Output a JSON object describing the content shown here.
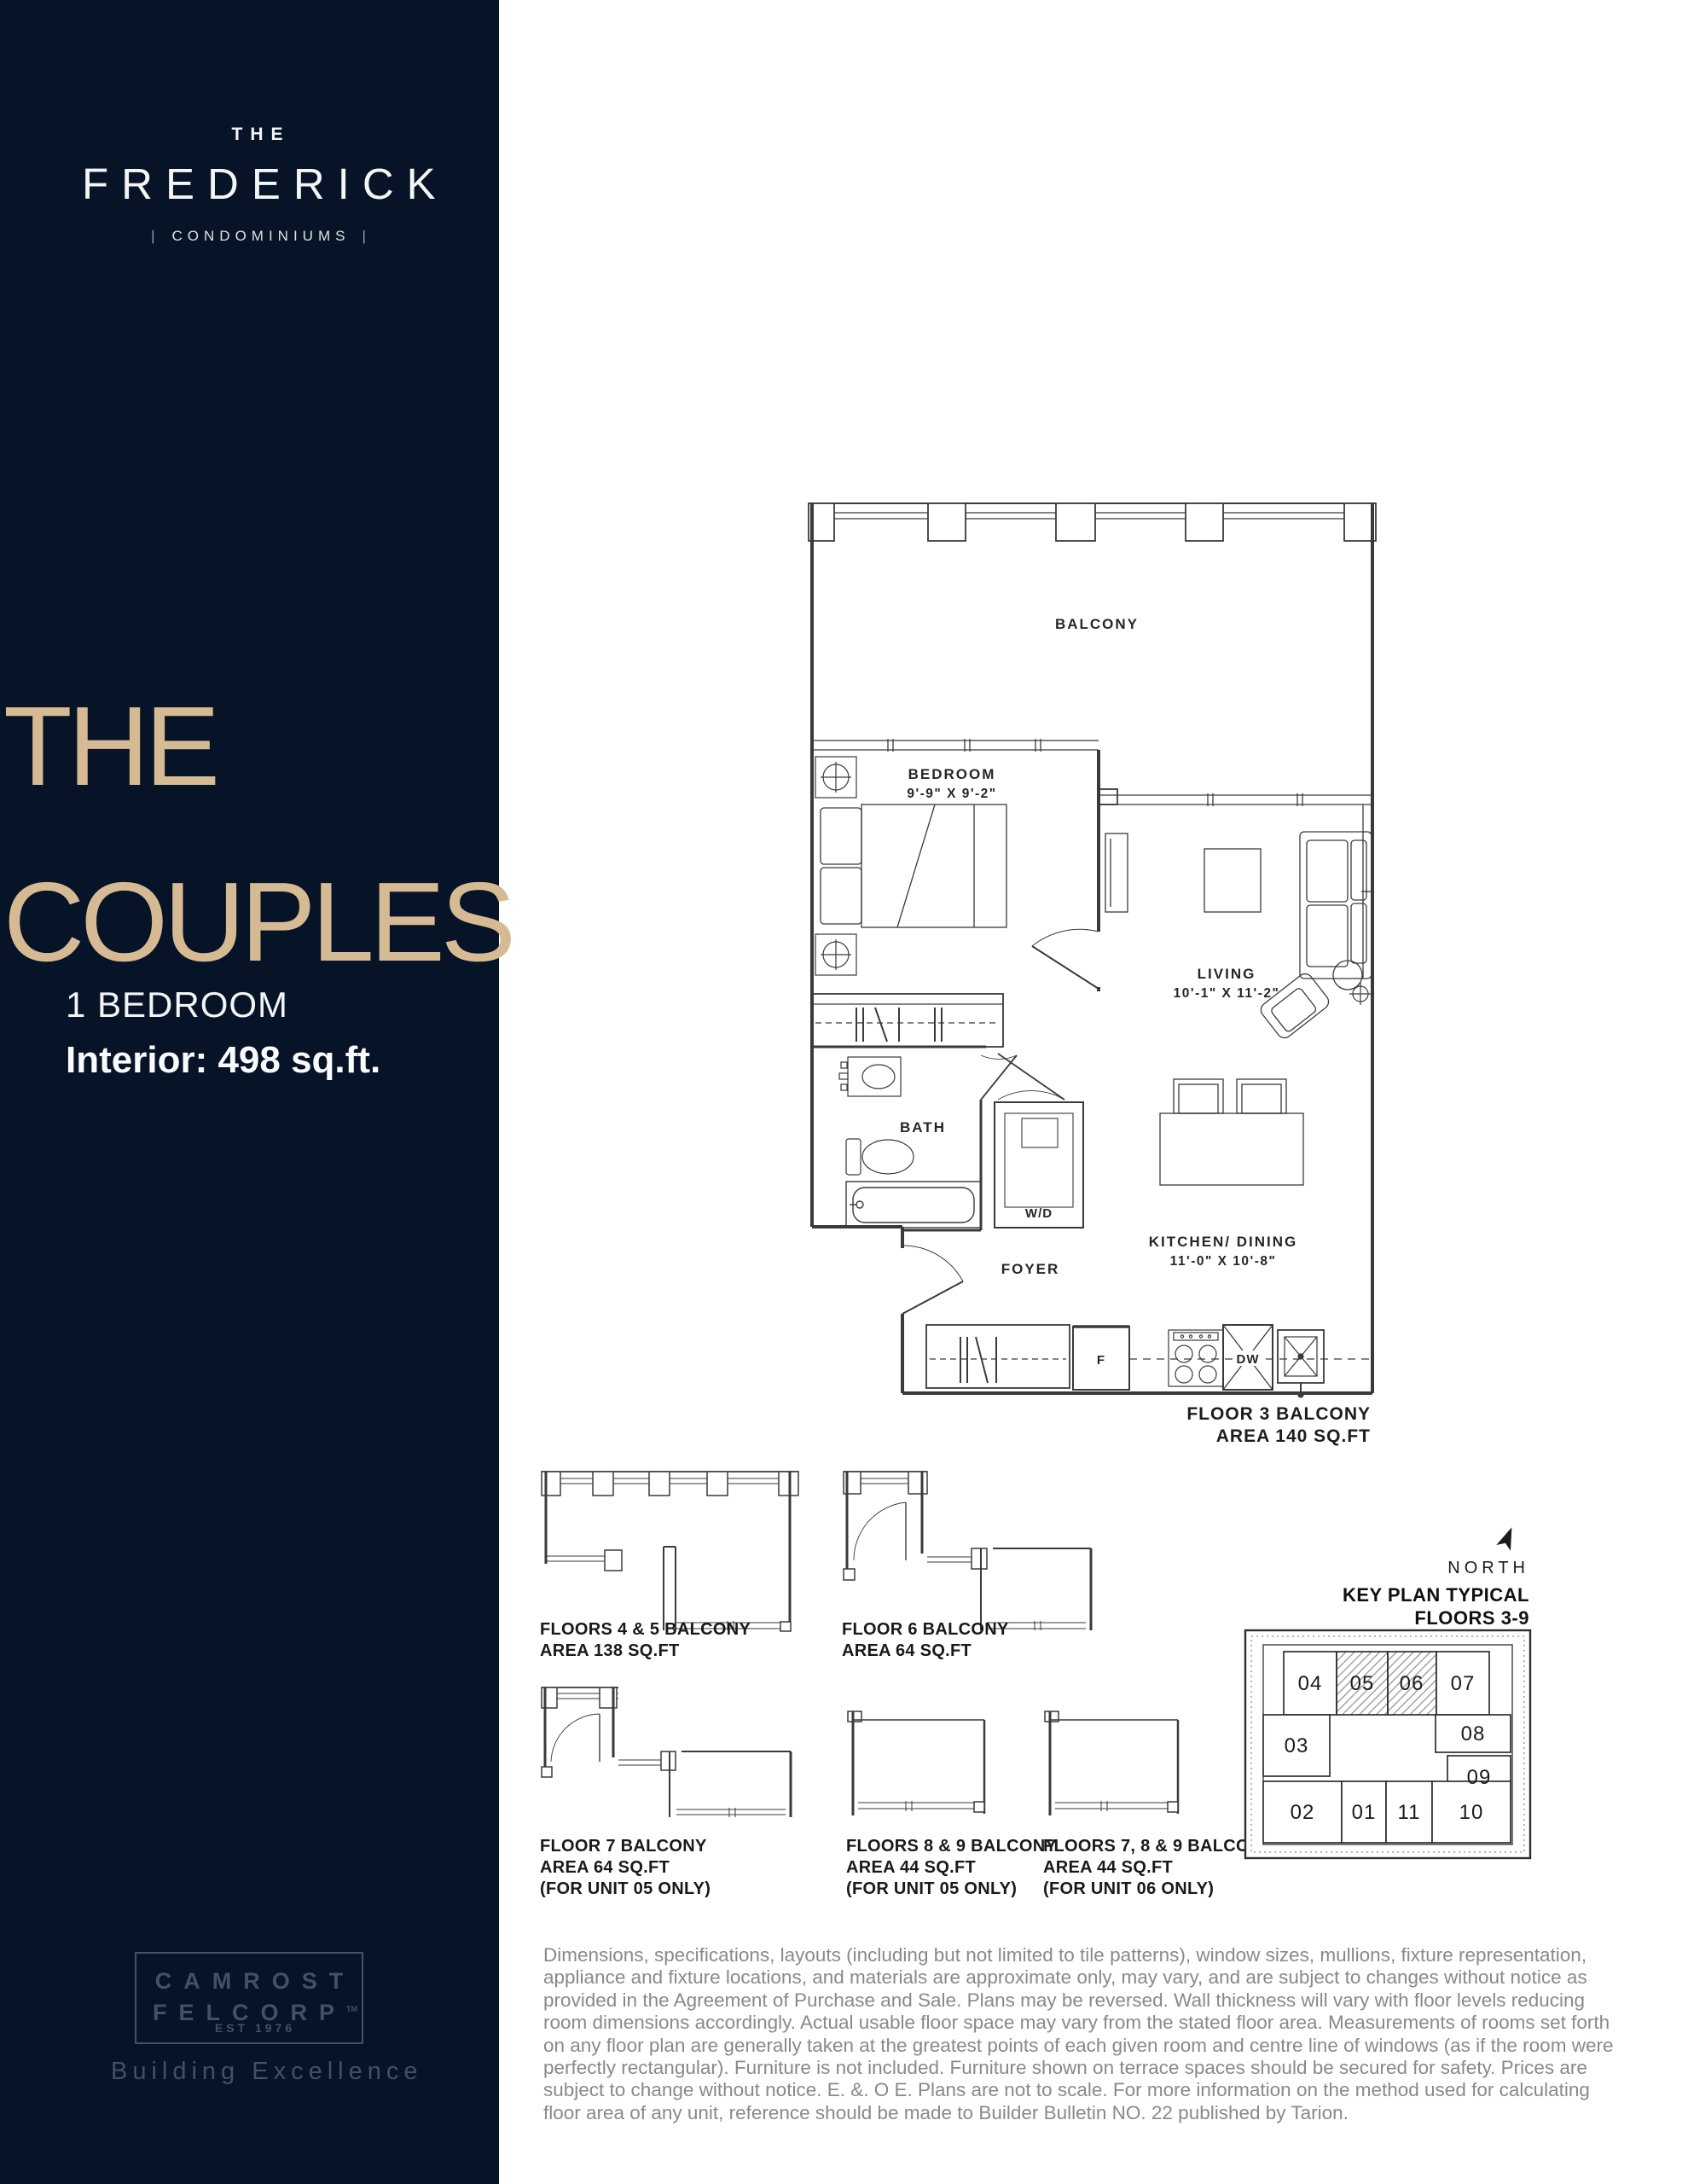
{
  "colors": {
    "navy": "#071326",
    "gold": "#d6ba93",
    "logo_muted": "#41506b",
    "plan_line": "#3a3a3a",
    "disclaimer_gray": "#87898b"
  },
  "sidebar": {
    "logo": {
      "the": "THE",
      "name": "FREDERICK",
      "tagline": "CONDOMINIUMS",
      "bar": "|"
    },
    "plan_title": {
      "line1": "THE",
      "line2": "COUPLES"
    },
    "bedrooms": "1 BEDROOM",
    "interior": "Interior: 498 sq.ft.",
    "developer": {
      "line1": "CAMROST",
      "line2": "FELCORP",
      "tm": "TM",
      "est": "EST 1976",
      "tagline": "Building Excellence"
    }
  },
  "floorplan": {
    "balcony": "BALCONY",
    "bedroom": {
      "name": "BEDROOM",
      "dims": "9'-9\" X 9'-2\""
    },
    "living": {
      "name": "LIVING",
      "dims": "10'-1\" X 11'-2\""
    },
    "bath": "BATH",
    "wd": "W/D",
    "foyer": "FOYER",
    "kitchen": {
      "name": "KITCHEN/ DINING",
      "dims": "11'-0\" X 10'-8\""
    },
    "fridge": "F",
    "dishwasher": "DW",
    "floor3_balcony": {
      "line1": "FLOOR 3 BALCONY",
      "line2": "AREA 140 SQ.FT"
    }
  },
  "balcony_variants": [
    {
      "line1": "FLOORS 4 & 5 BALCONY",
      "line2": "AREA 138 SQ.FT",
      "line3": ""
    },
    {
      "line1": "FLOOR 6 BALCONY",
      "line2": "AREA 64 SQ.FT",
      "line3": ""
    },
    {
      "line1": "FLOOR 7 BALCONY",
      "line2": "AREA 64 SQ.FT",
      "line3": "(FOR UNIT 05 ONLY)"
    },
    {
      "line1": "FLOORS 8 & 9 BALCONY",
      "line2": "AREA 44 SQ.FT",
      "line3": "(FOR UNIT 05 ONLY)"
    },
    {
      "line1": "FLOORS 7, 8 & 9 BALCONY",
      "line2": "AREA 44 SQ.FT",
      "line3": "(FOR UNIT 06 ONLY)"
    }
  ],
  "keyplan": {
    "north": "NORTH",
    "title": {
      "line1": "KEY PLAN TYPICAL",
      "line2": "FLOORS 3-9"
    },
    "units": [
      {
        "label": "04",
        "highlighted": false
      },
      {
        "label": "05",
        "highlighted": true
      },
      {
        "label": "06",
        "highlighted": true
      },
      {
        "label": "07",
        "highlighted": false
      },
      {
        "label": "03",
        "highlighted": false
      },
      {
        "label": "08",
        "highlighted": false
      },
      {
        "label": "09",
        "highlighted": false
      },
      {
        "label": "02",
        "highlighted": false
      },
      {
        "label": "01",
        "highlighted": false
      },
      {
        "label": "11",
        "highlighted": false
      },
      {
        "label": "10",
        "highlighted": false
      }
    ]
  },
  "disclaimer": "Dimensions, specifications, layouts (including but not limited to tile patterns), window sizes, mullions, fixture representation, appliance and fixture locations, and materials are approximate only, may vary, and are subject to changes without notice as provided in the Agreement of Purchase and Sale.  Plans may be reversed.  Wall thickness will vary with floor levels reducing room dimensions accordingly. Actual usable floor space may vary from the stated floor area.  Measurements of rooms set forth on any floor plan are generally taken at the greatest points of each given room and centre line of windows (as if the room were perfectly rectangular).  Furniture is not included.  Furniture shown on terrace spaces should be secured for safety.  Prices are subject to change without notice.  E. &. O E. Plans are not to scale. For more information on the method used for calculating floor area of any unit, reference should be made to Builder Bulletin NO. 22 published by Tarion."
}
